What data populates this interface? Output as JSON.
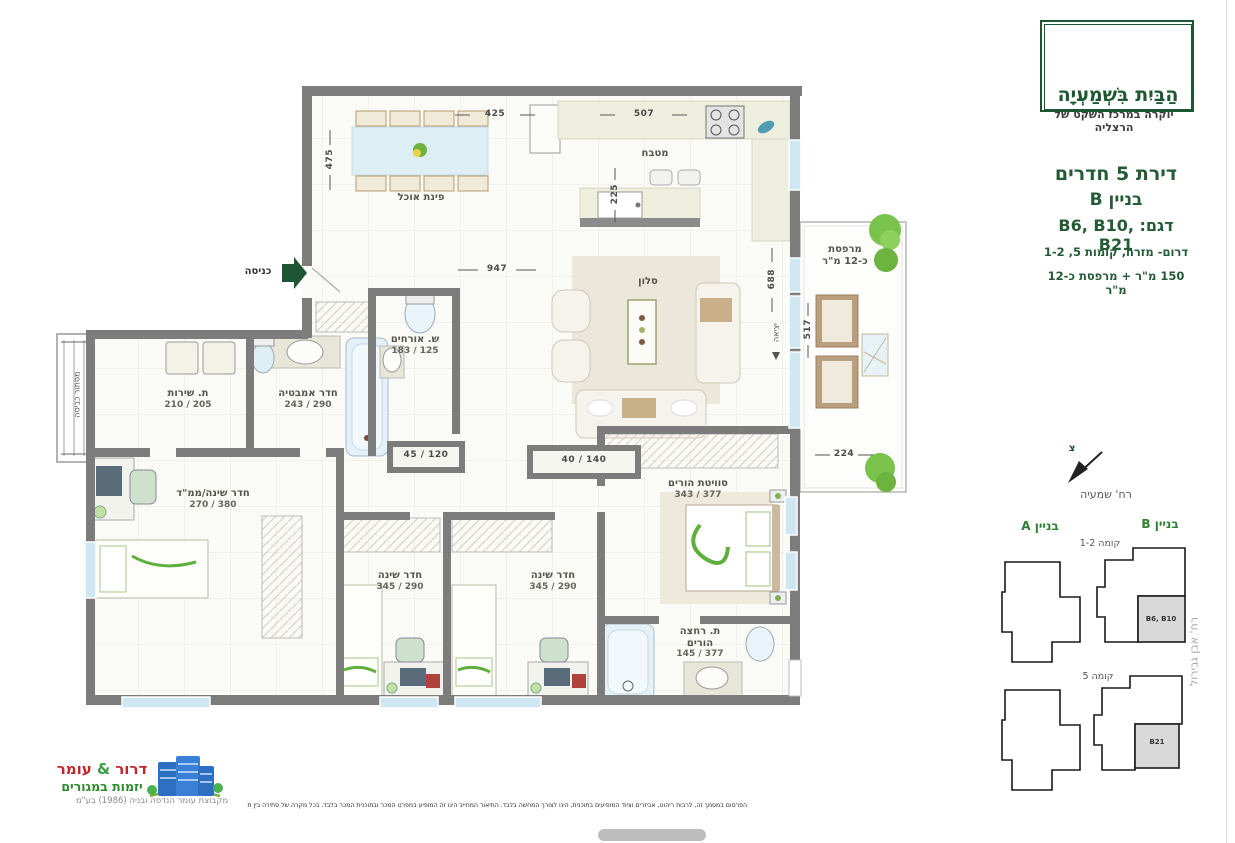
{
  "brand": {
    "title": "הַבַּיִת בִּשְׁמַעְיָה",
    "tagline": "יוקרה במרכז השקט של הרצליה"
  },
  "unit": {
    "type": "דירת 5 חדרים",
    "building": "בניין B",
    "models": "דגם: B6, B10, B21",
    "orientation": "דרום- מזרח, קומות 5, 1-2",
    "area": "150 מ\"ר + מרפסת כ-12 מ\"ר"
  },
  "plan": {
    "entrance": "כניסה",
    "exit": "יציאה",
    "laundry": "מסתור כביסה",
    "rooms": {
      "dining": {
        "name": "פינת אוכל"
      },
      "kitchen": {
        "name": "מטבח"
      },
      "living": {
        "name": "סלון"
      },
      "guest_wc": {
        "name": "ש. אורחים",
        "dims": "125 / 183"
      },
      "bathroom": {
        "name": "חדר אמבטיה",
        "dims": "290 / 243"
      },
      "utility": {
        "name": "ת. שירות",
        "dims": "205 / 210"
      },
      "mamad": {
        "name": "חדר שינה/ממ\"ד",
        "dims": "380 / 270"
      },
      "suite": {
        "name": "סוויטת הורים",
        "dims": "377 / 343"
      },
      "bedroom1": {
        "name": "חדר שינה",
        "dims": "290 / 345"
      },
      "bedroom2": {
        "name": "חדר שינה",
        "dims": "290 / 345"
      },
      "parents_bath": {
        "name1": "ת. רחצה",
        "name2": "הורים",
        "dims": "377 / 145"
      },
      "balcony": {
        "name1": "מרפסת",
        "name2": "כ-12 מ\"ר"
      },
      "closet_small": {
        "dims": "120 / 45"
      },
      "closet_large": {
        "dims": "140 / 40"
      }
    },
    "dims": {
      "top1": "425",
      "top2": "507",
      "left": "475",
      "kitchen": "225",
      "mid": "947",
      "right": "688",
      "balcony_v": "517",
      "balcony_h": "224"
    }
  },
  "keyplan": {
    "north": "צ",
    "street": "רח' שמעיה",
    "side_street": "רח' אבן גבירול",
    "building_a": "בניין A",
    "building_b": "בניין B",
    "floors_1_2": "קומה 1-2",
    "floor_5": "קומה 5",
    "unit_top": "B6, B10",
    "unit_bottom": "B21"
  },
  "developer": {
    "name1": "דרור",
    "amp": "&",
    "name2": "עומר",
    "subtitle": "יזמות במגורים",
    "group": "מקבוצת עומר הנדסה ובניה (1986) בע\"מ"
  },
  "disclaimer": "הפרסום במסמך זה, לרבות ריהוט, אביזרים וציוד המופיעים בתוכנית, הינו לצורך המחשה בלבד. התיאור המחייב הינו זה המופיע במפרט המכר ובתוכנית המכר בלבד. בכל מקרה של סתירה בין תוכנית זו לבין מפרט המכר, יגבר האמור במפרט המכר. תוכנית זו אינה מהווה מצג או התחייבות ולא תהווה חלק ממסמכי ההתקשרות המחייבים בין הצדדים. עודכן 2/2/2023",
  "colors": {
    "brand_green": "#1d5632",
    "wall_gray": "#7c7c7c",
    "window_blue": "#cfe7f3",
    "developer_red": "#c0272d",
    "developer_green": "#2e8b2e",
    "tree_green": "#79c24c"
  }
}
